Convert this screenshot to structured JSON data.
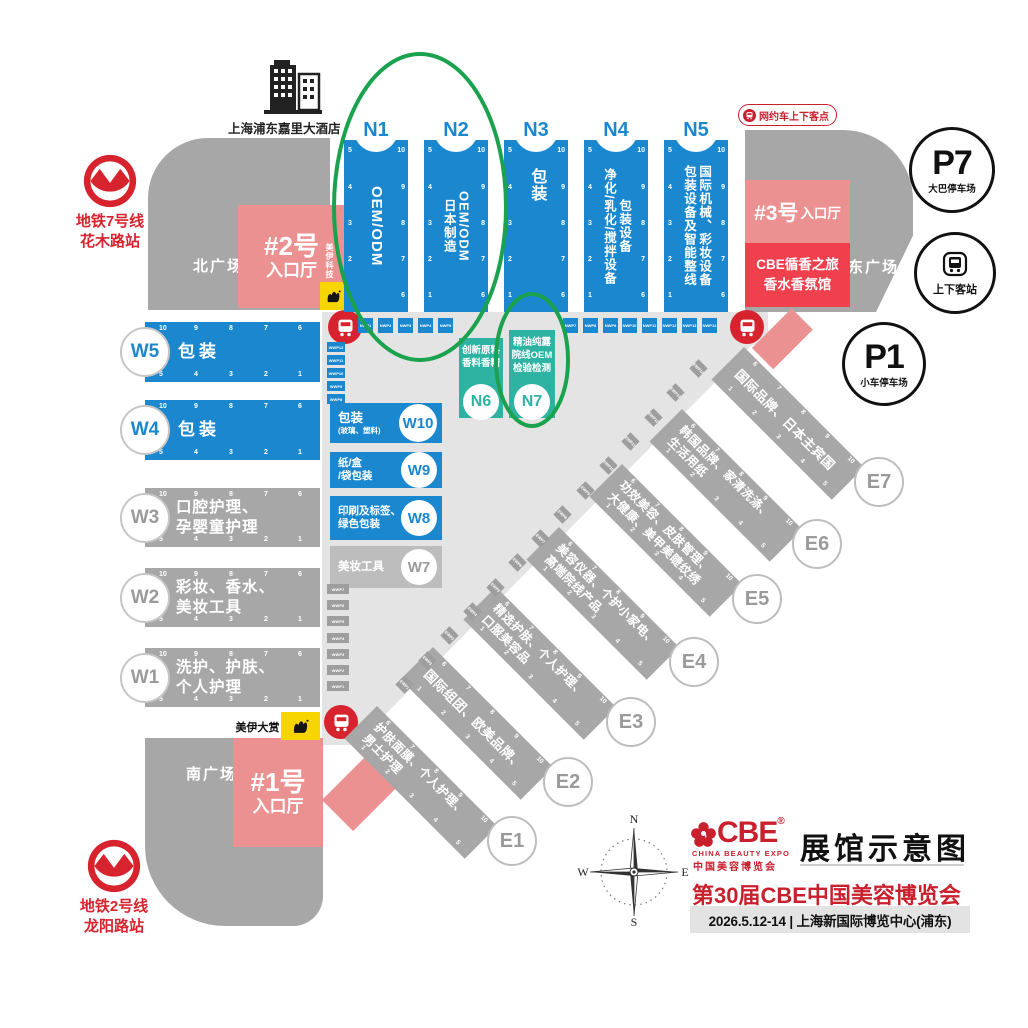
{
  "colors": {
    "blue": "#1b87ce",
    "teal": "#2eb3a3",
    "gray_hall": "#a7a7a7",
    "gray_light": "#bdbdbd",
    "corridor": "#e4e4e4",
    "pink": "#ec9191",
    "red_block": "#f0404e",
    "accent_red": "#d7232e",
    "title_red": "#c9202e",
    "yellow": "#f6d500",
    "green_highlight": "#1ba24e"
  },
  "landmarks": {
    "hotel": {
      "label": "上海浦东嘉里大酒店"
    },
    "metro7": {
      "line1": "地铁7号线",
      "line2": "花木路站"
    },
    "metro2": {
      "line1": "地铁2号线",
      "line2": "龙阳路站"
    },
    "plaza_north": "北广场",
    "plaza_east": "东广场",
    "plaza_south": "南广场",
    "entrance2": {
      "line1": "#2号",
      "line2": "入口厅"
    },
    "entrance1": {
      "line1": "#1号",
      "line2": "入口厅"
    },
    "entrance3": {
      "big": "#3号",
      "small": "入口厅"
    },
    "scent_hall": {
      "line1": "CBE循香之旅",
      "line2": "香水香氛馆"
    },
    "ride_hailing": "网约车上下客点",
    "p7": {
      "id": "P7",
      "label": "大巴停车场"
    },
    "p1": {
      "id": "P1",
      "label": "小车停车场"
    },
    "dropoff": "上下客站",
    "badge_tech": "美伊科技",
    "badge_award": "美伊大赏"
  },
  "n_halls": [
    {
      "id": "N1",
      "columns": [
        "OEM/ODM"
      ]
    },
    {
      "id": "N2",
      "columns": [
        "日本制造",
        "OEM/ODM"
      ]
    },
    {
      "id": "N3",
      "columns": [
        "包装"
      ]
    },
    {
      "id": "N4",
      "columns": [
        "净化/乳化/搅拌设备",
        "包装设备"
      ]
    },
    {
      "id": "N5",
      "columns": [
        "包装设备及智能整线",
        "国际机械、彩妆设备"
      ]
    }
  ],
  "teal_halls": [
    {
      "id": "N6",
      "lines": [
        "创新原料",
        "香料香精"
      ]
    },
    {
      "id": "N7",
      "lines": [
        "精油纯露",
        "院线OEM",
        "检验检测"
      ]
    }
  ],
  "w_bars": [
    {
      "id": "W5",
      "color": "blue",
      "lines": [
        "包装"
      ]
    },
    {
      "id": "W4",
      "color": "blue",
      "lines": [
        "包装"
      ]
    },
    {
      "id": "W3",
      "color": "gray",
      "lines": [
        "口腔护理、",
        "孕婴童护理"
      ]
    },
    {
      "id": "W2",
      "color": "gray",
      "lines": [
        "彩妆、香水、",
        "美妆工具"
      ]
    },
    {
      "id": "W1",
      "color": "gray",
      "lines": [
        "洗护、护肤、",
        "个人护理"
      ]
    }
  ],
  "w_blocks": [
    {
      "id": "W10",
      "color": "blue",
      "lines": [
        "包装",
        "(玻璃、塑料)"
      ]
    },
    {
      "id": "W9",
      "color": "blue",
      "lines": [
        "纸/盒",
        "/袋包装"
      ]
    },
    {
      "id": "W8",
      "color": "blue",
      "lines": [
        "印刷及标签、",
        "绿色包装"
      ]
    },
    {
      "id": "W7",
      "color": "gray",
      "lines": [
        "美妆工具"
      ]
    }
  ],
  "e_bars": [
    {
      "id": "E1",
      "lines": [
        "护肤面膜、个人护理、",
        "男士护理"
      ]
    },
    {
      "id": "E2",
      "lines": [
        "国际组团、欧美品牌、"
      ]
    },
    {
      "id": "E3",
      "lines": [
        "精选护肤、个人护理、",
        "口服美容品"
      ]
    },
    {
      "id": "E4",
      "lines": [
        "美容仪器、个护小家电、",
        "高端院线产品"
      ]
    },
    {
      "id": "E5",
      "lines": [
        "功效美容、皮肤管理、",
        "大健康、美甲美睫纹绣"
      ]
    },
    {
      "id": "E6",
      "lines": [
        "韩国品牌、家清洗涤、",
        "生活用纸"
      ]
    },
    {
      "id": "E7",
      "lines": [
        "国际品牌、日本主宾国"
      ]
    }
  ],
  "edge_numbers": {
    "vertical_left": [
      "5",
      "4",
      "3",
      "2",
      "1"
    ],
    "vertical_right": [
      "10",
      "9",
      "8",
      "7",
      "6"
    ],
    "horizontal_top": [
      "10",
      "9",
      "8",
      "7",
      "6"
    ],
    "horizontal_bottom": [
      "5",
      "4",
      "3",
      "2",
      "1"
    ],
    "diagonal_top": [
      "6",
      "7",
      "8",
      "9",
      "10"
    ],
    "diagonal_bottom": [
      "1",
      "2",
      "3",
      "4",
      "5"
    ]
  },
  "markers": {
    "top_left": [
      "NWP1",
      "NWP2",
      "NWP3",
      "NWP4",
      "NWP5"
    ],
    "top_right": [
      "NWP7",
      "NWP8",
      "NWP9",
      "NWP10",
      "NWP11",
      "NWP12",
      "NWP13",
      "NWP14"
    ],
    "west_blue": [
      "WWP12",
      "WWP11",
      "WWP10",
      "WWP9",
      "WWP8"
    ],
    "west_gray": [
      "WWP7",
      "WWP6",
      "WWP5",
      "WWP4",
      "WWP3",
      "WWP2",
      "WWP1"
    ],
    "east_diag": [
      "EWP14",
      "EWP13",
      "EWP12",
      "EWP11",
      "EWP10",
      "EWP9",
      "EWP8",
      "EWP7",
      "EWP6",
      "EWP5",
      "EWP4",
      "EWP3",
      "EWP2",
      "EWP1"
    ]
  },
  "compass": {
    "n": "N",
    "e": "E",
    "s": "S",
    "w": "W"
  },
  "title_block": {
    "logo_text": "CBE",
    "logo_reg": "®",
    "logo_sub1": "CHINA BEAUTY EXPO",
    "logo_sub2": "中国美容博览会",
    "title": "展馆示意图",
    "subtitle": "第30届CBE中国美容博览会",
    "date_venue": "2026.5.12-14 | 上海新国际博览中心(浦东)"
  }
}
